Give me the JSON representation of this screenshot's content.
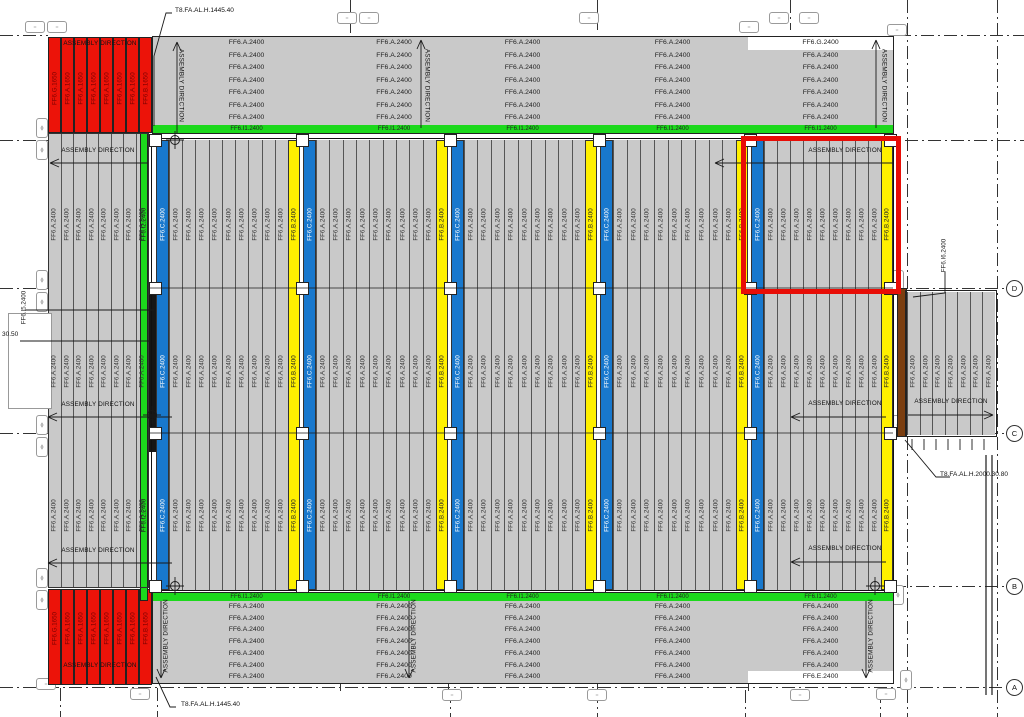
{
  "drawing": {
    "assembly_direction": "ASSEMBLY DIRECTION",
    "callout_top": "T8.FA.AL.H.1445.40",
    "callout_bottom": "T8.FA.AL.H.1445.40",
    "callout_right": "T8.FA.AL.H.2000.30.80",
    "dim_left": "30.50",
    "left_edge_label": "FF6.I5.2400",
    "right_edge_label": "FF6.I6.2400",
    "grid_bubbles": [
      "D",
      "C",
      "B",
      "A"
    ],
    "panels": {
      "plank": "FF6.A.2400",
      "yellow": "FF6.B.2400",
      "blue": "FF6.C.2400",
      "green_horizontal": "FF6.I1.2400",
      "green_vertical": "FF6.I2.2400",
      "top_right_first_row": "FF6.G.2400",
      "bottom_right_last_row": "FF6.E.2400",
      "red_first": "FF6.G.1650",
      "red_middle": "FF6.A.1650",
      "red_last": "FF6.B.1650"
    },
    "colors": {
      "red": "#ec1309",
      "green": "#1cd91c",
      "blue": "#1878cd",
      "yellow": "#fff000",
      "gray": "#c9c9c9",
      "brown": "#7b3e10",
      "black": "#161616"
    }
  }
}
